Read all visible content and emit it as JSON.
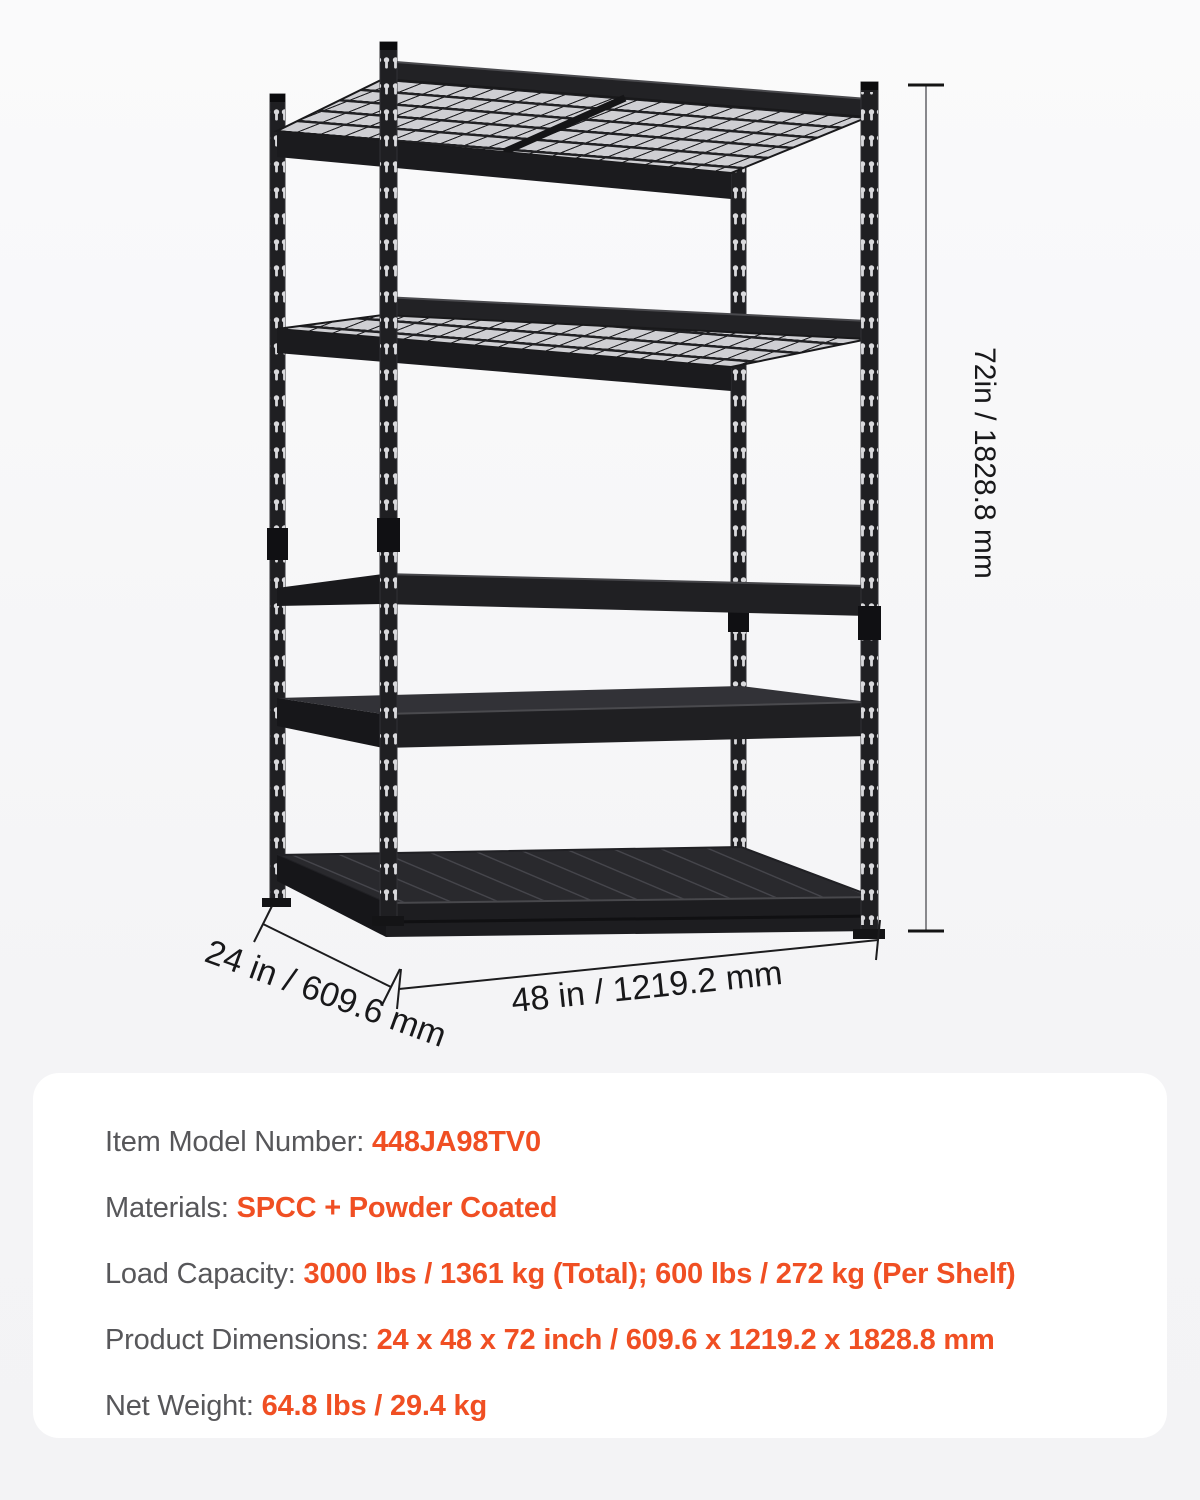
{
  "diagram": {
    "shelf_count": 5,
    "height_label": "72in / 1828.8 mm",
    "depth_label": "24 in / 609.6 mm",
    "width_label": "48 in / 1219.2 mm"
  },
  "specs": {
    "rows": [
      {
        "label": "Item Model Number: ",
        "value": "448JA98TV0"
      },
      {
        "label": "Materials: ",
        "value": "SPCC + Powder Coated"
      },
      {
        "label": "Load Capacity: ",
        "value": "3000 lbs / 1361 kg (Total); 600 lbs / 272 kg (Per Shelf)"
      },
      {
        "label": "Product Dimensions: ",
        "value": "24 x 48 x 72 inch / 609.6 x 1219.2 x 1828.8 mm"
      },
      {
        "label": "Net Weight: ",
        "value": "64.8 lbs / 29.4 kg"
      }
    ]
  },
  "colors": {
    "accent_orange": "#F04F23",
    "label_gray": "#57575a",
    "panel_background": "#ffffff",
    "page_background": "#f4f4f6",
    "rack_black": "#1f1f22"
  }
}
